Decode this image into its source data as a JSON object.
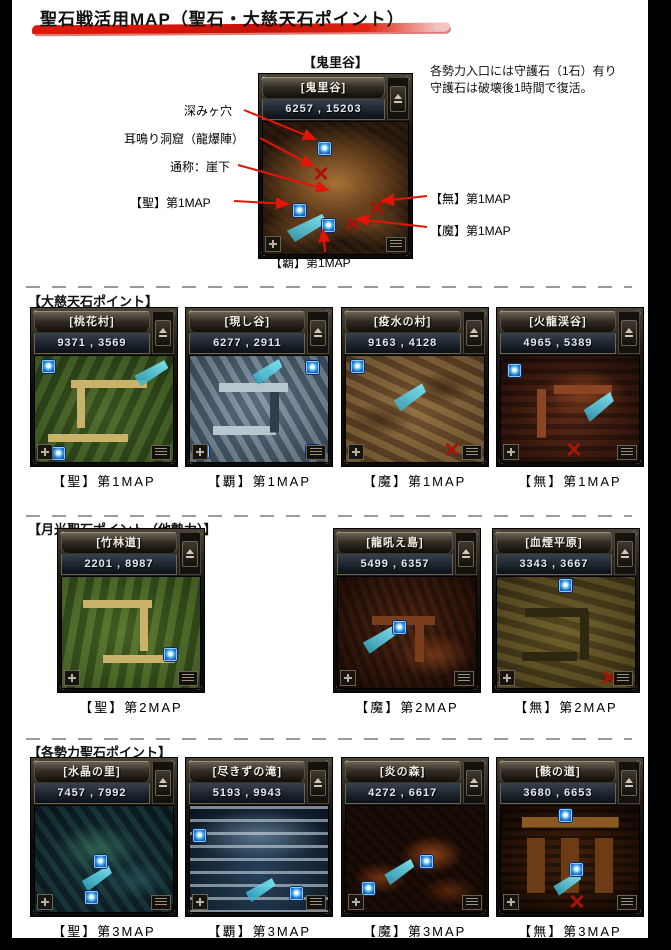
{
  "colors": {
    "annotation_red": "#e41408",
    "brush_red": "#d01208",
    "marker_blue": "#1a63c6",
    "beam_cyan": "#46c8e0",
    "x_mark_red": "#a81408",
    "page_background": "#ffffff",
    "frame_black": "#000000"
  },
  "title": "聖石戦活用MAP（聖石・大慈天石ポイント）",
  "top_section": {
    "heading": "【鬼里谷】",
    "map": {
      "name": "[鬼里谷]",
      "coords": "6257 , 15203"
    },
    "note": {
      "line1": "各勢力入口には守護石（1石）有り",
      "line2": "守護石は破壊後1時間で復活。"
    },
    "labels": {
      "deep_hole": "深みヶ穴",
      "ear_cave": "耳鳴り洞窟（龍爆陣）",
      "cliff": "通称：崖下",
      "holy": "【聖】第1MAP",
      "supreme": "【覇】第1MAP",
      "neutral": "【無】第1MAP",
      "demon": "【魔】第1MAP"
    }
  },
  "sections": [
    {
      "heading": "【大慈天石ポイント】",
      "maps": [
        {
          "name": "[桃花村]",
          "coords": "9371 , 3569",
          "caption": "【聖】第1MAP"
        },
        {
          "name": "[現し谷]",
          "coords": "6277 , 2911",
          "caption": "【覇】第1MAP"
        },
        {
          "name": "[疫水の村]",
          "coords": "9163 , 4128",
          "caption": "【魔】第1MAP"
        },
        {
          "name": "[火龍渓谷]",
          "coords": "4965 , 5389",
          "caption": "【無】第1MAP"
        }
      ]
    },
    {
      "heading": "【月光聖石ポイント（他勢力）】",
      "maps": [
        {
          "name": "[竹林道]",
          "coords": "2201 , 8987",
          "caption": "【聖】第2MAP"
        },
        {
          "name": "[龍吼え島]",
          "coords": "5499 , 6357",
          "caption": "【魔】第2MAP"
        },
        {
          "name": "[血煙平原]",
          "coords": "3343 , 3667",
          "caption": "【無】第2MAP"
        }
      ]
    },
    {
      "heading": "【各勢力聖石ポイント】",
      "maps": [
        {
          "name": "[水晶の里]",
          "coords": "7457 , 7992",
          "caption": "【聖】第3MAP"
        },
        {
          "name": "[尽きずの滝]",
          "coords": "5193 , 9943",
          "caption": "【覇】第3MAP"
        },
        {
          "name": "[炎の森]",
          "coords": "4272 , 6617",
          "caption": "【魔】第3MAP"
        },
        {
          "name": "[骸の道]",
          "coords": "3680 , 6653",
          "caption": "【無】第3MAP"
        }
      ]
    }
  ]
}
